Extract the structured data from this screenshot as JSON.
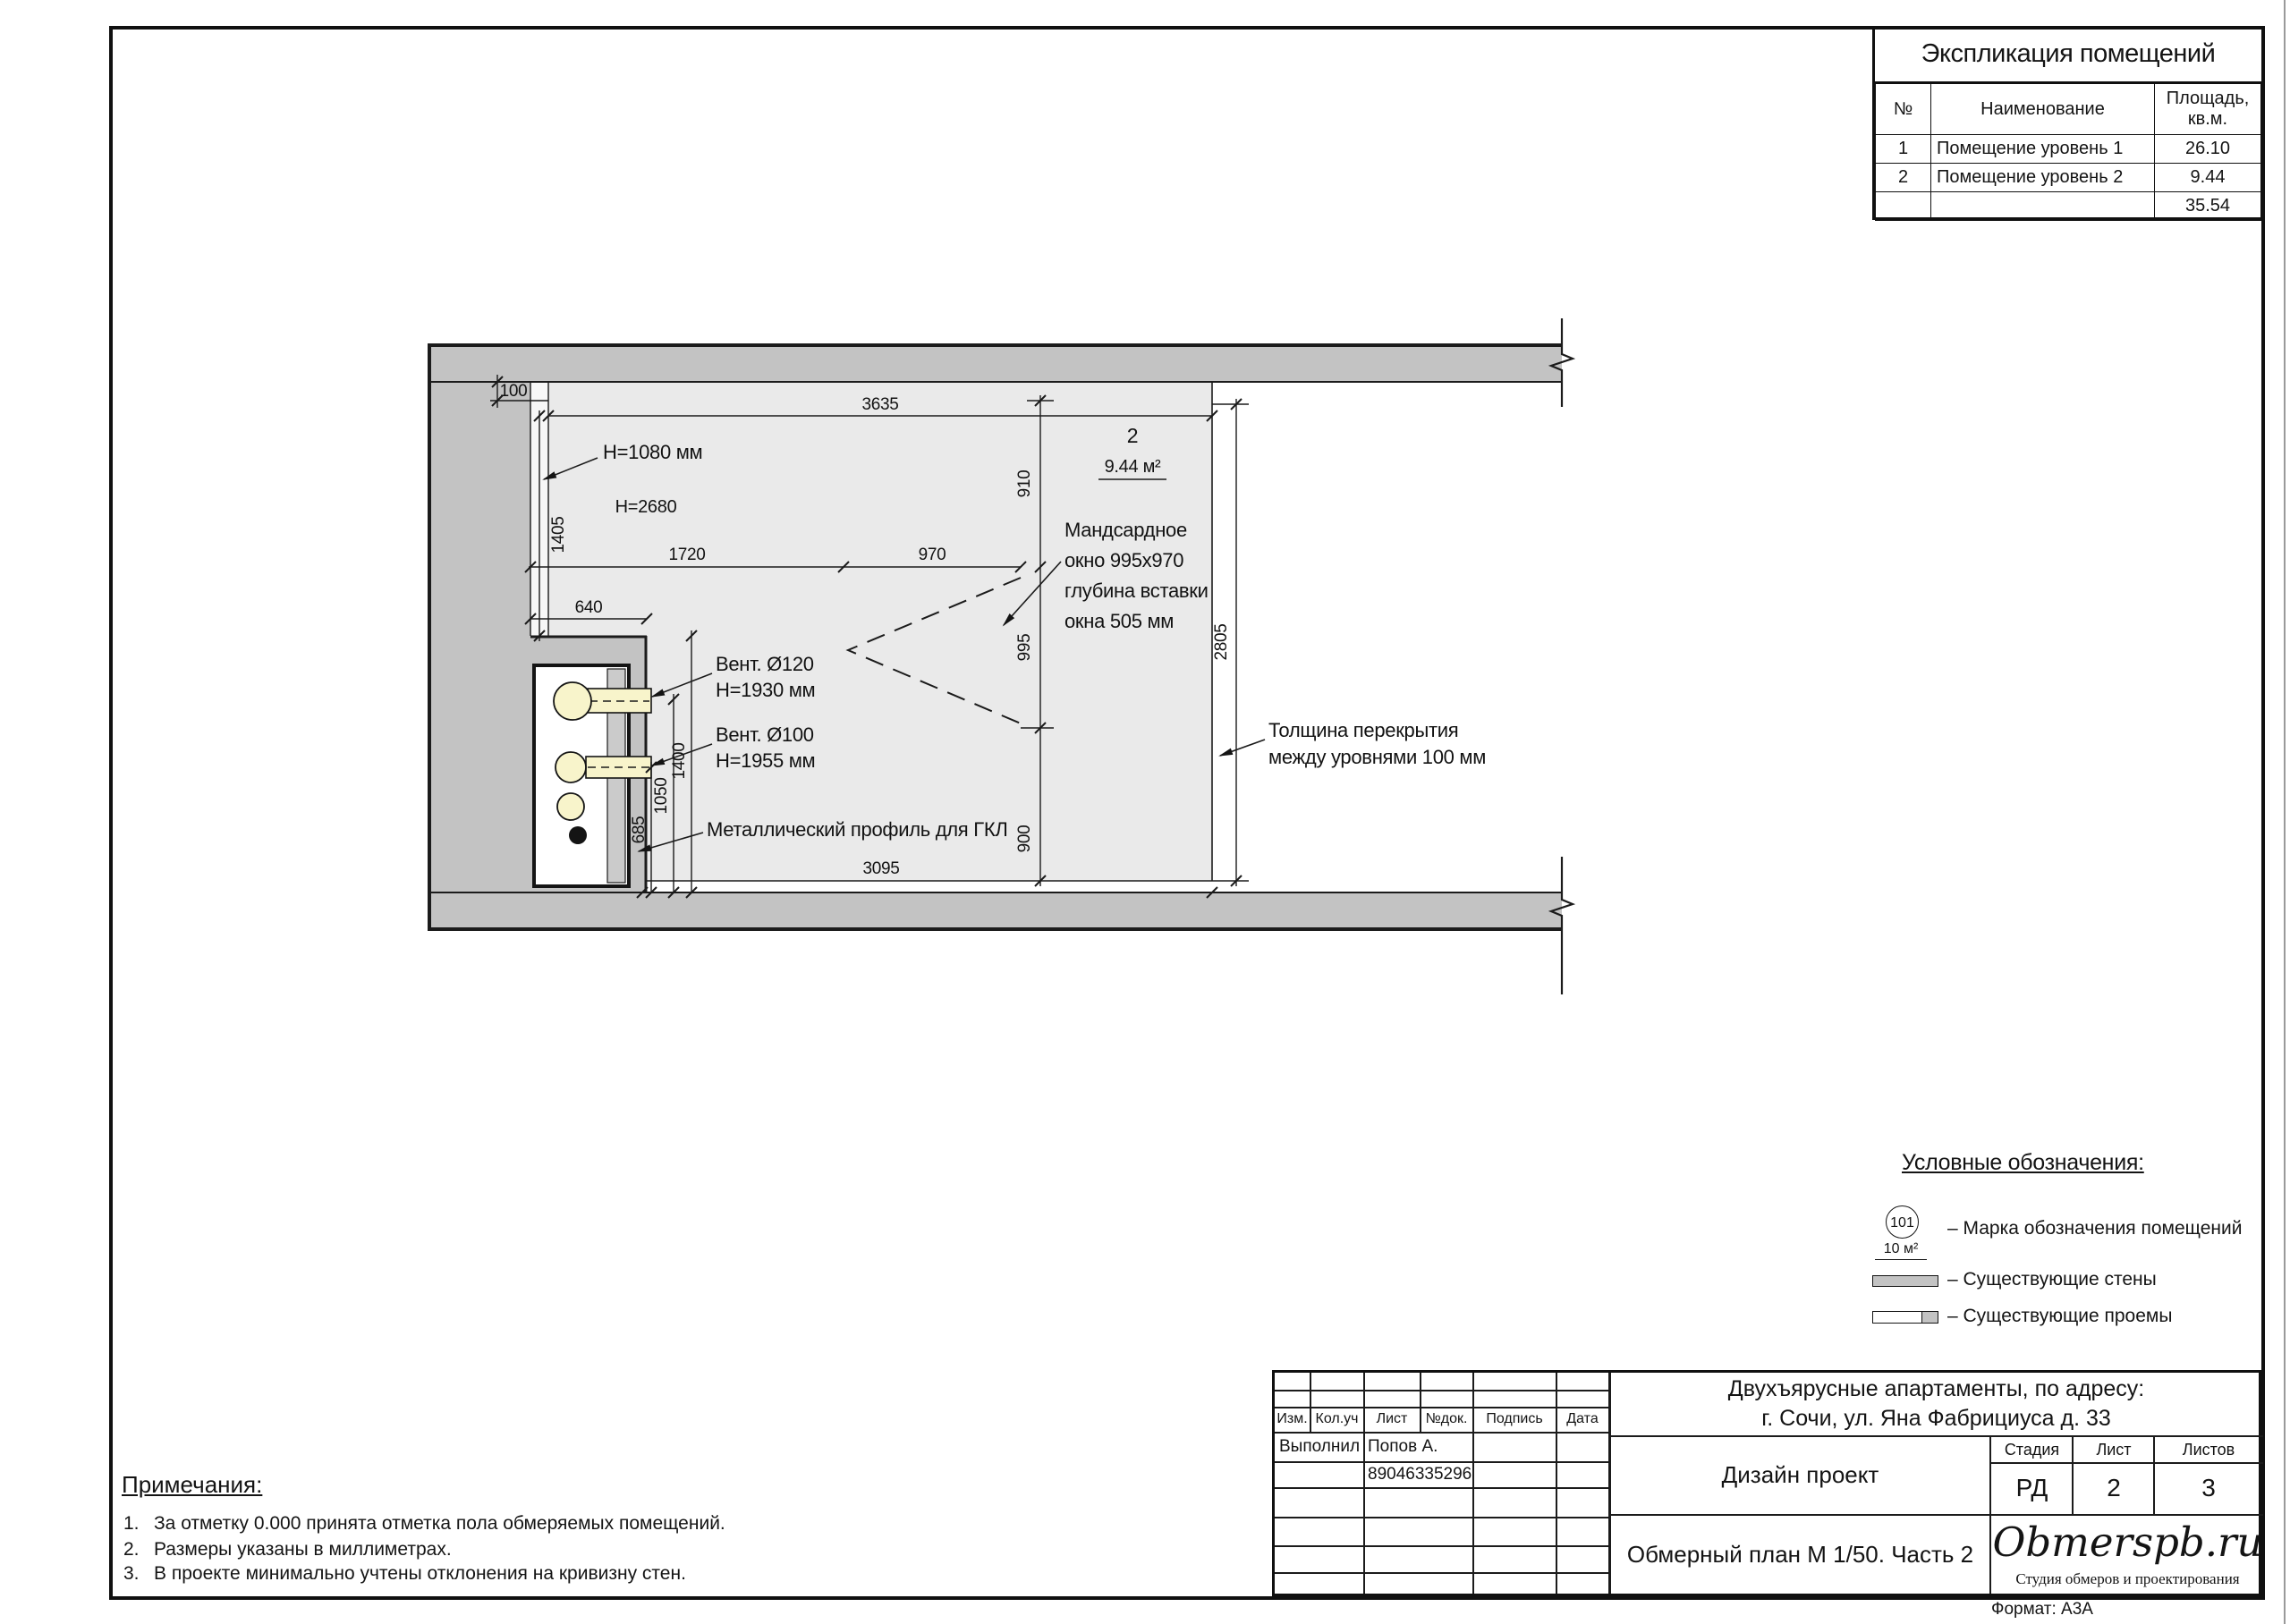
{
  "explication": {
    "title": "Экспликация помещений",
    "col_no": "№",
    "col_name": "Наименование",
    "col_area_1": "Площадь,",
    "col_area_2": "кв.м.",
    "rows": [
      {
        "no": "1",
        "name": "Помещение уровень 1",
        "area": "26.10"
      },
      {
        "no": "2",
        "name": "Помещение уровень 2",
        "area": "9.44"
      }
    ],
    "total": "35.54"
  },
  "plan": {
    "dims": {
      "d100": "100",
      "d3635": "3635",
      "d1405": "1405",
      "d1720": "1720",
      "d970": "970",
      "d910": "910",
      "d995": "995",
      "d900": "900",
      "d2805": "2805",
      "d640": "640",
      "d685": "685",
      "d1050": "1050",
      "d1400": "1400",
      "d3095": "3095"
    },
    "labels": {
      "h1080": "H=1080 мм",
      "h2680": "H=2680",
      "room_no": "2",
      "room_area": "9.44 м²",
      "win1": "Мандсардное",
      "win2": "окно 995х970",
      "win3": "глубина вставки",
      "win4": "окна 505 мм",
      "vent1a": "Вент. Ø120",
      "vent1b": "H=1930 мм",
      "vent2a": "Вент. Ø100",
      "vent2b": "H=1955 мм",
      "profile": "Металлический профиль для ГКЛ",
      "slab1": "Толщина перекрытия",
      "slab2": "между уровнями 100 мм"
    }
  },
  "legend": {
    "title": "Условные обозначения:",
    "marker_no": "101",
    "marker_area": "10 м²",
    "item_marker": "– Марка обозначения помещений",
    "item_walls": "– Существующие стены",
    "item_openings": "– Существующие проемы"
  },
  "notes": {
    "title": "Примечания:",
    "items": [
      {
        "num": "1.",
        "text": "За отметку 0.000 принята отметка пола обмеряемых помещений."
      },
      {
        "num": "2.",
        "text": "Размеры указаны в миллиметрах."
      },
      {
        "num": "3.",
        "text": "В проекте минимально учтены отклонения на кривизну стен."
      }
    ]
  },
  "titleblock": {
    "h_izm": "Изм.",
    "h_koluch": "Кол.уч",
    "h_list": "Лист",
    "h_ndok": "№док.",
    "h_podpis": "Подпись",
    "h_data": "Дата",
    "role": "Выполнил",
    "name": "Попов А.",
    "phone": "89046335296",
    "project1": "Двухъярусные апартаменты, по адресу:",
    "project2": "г. Сочи, ул. Яна Фабрициуса д. 33",
    "doc_type": "Дизайн проект",
    "stage_label": "Стадия",
    "sheet_label": "Лист",
    "sheets_label": "Листов",
    "stage": "РД",
    "sheet": "2",
    "sheets": "3",
    "doc_name": "Обмерный план М 1/50. Часть 2",
    "logo": "Obmerspb.ru",
    "logo_sub": "Студия обмеров и проектирования",
    "format": "Формат: А3А"
  }
}
